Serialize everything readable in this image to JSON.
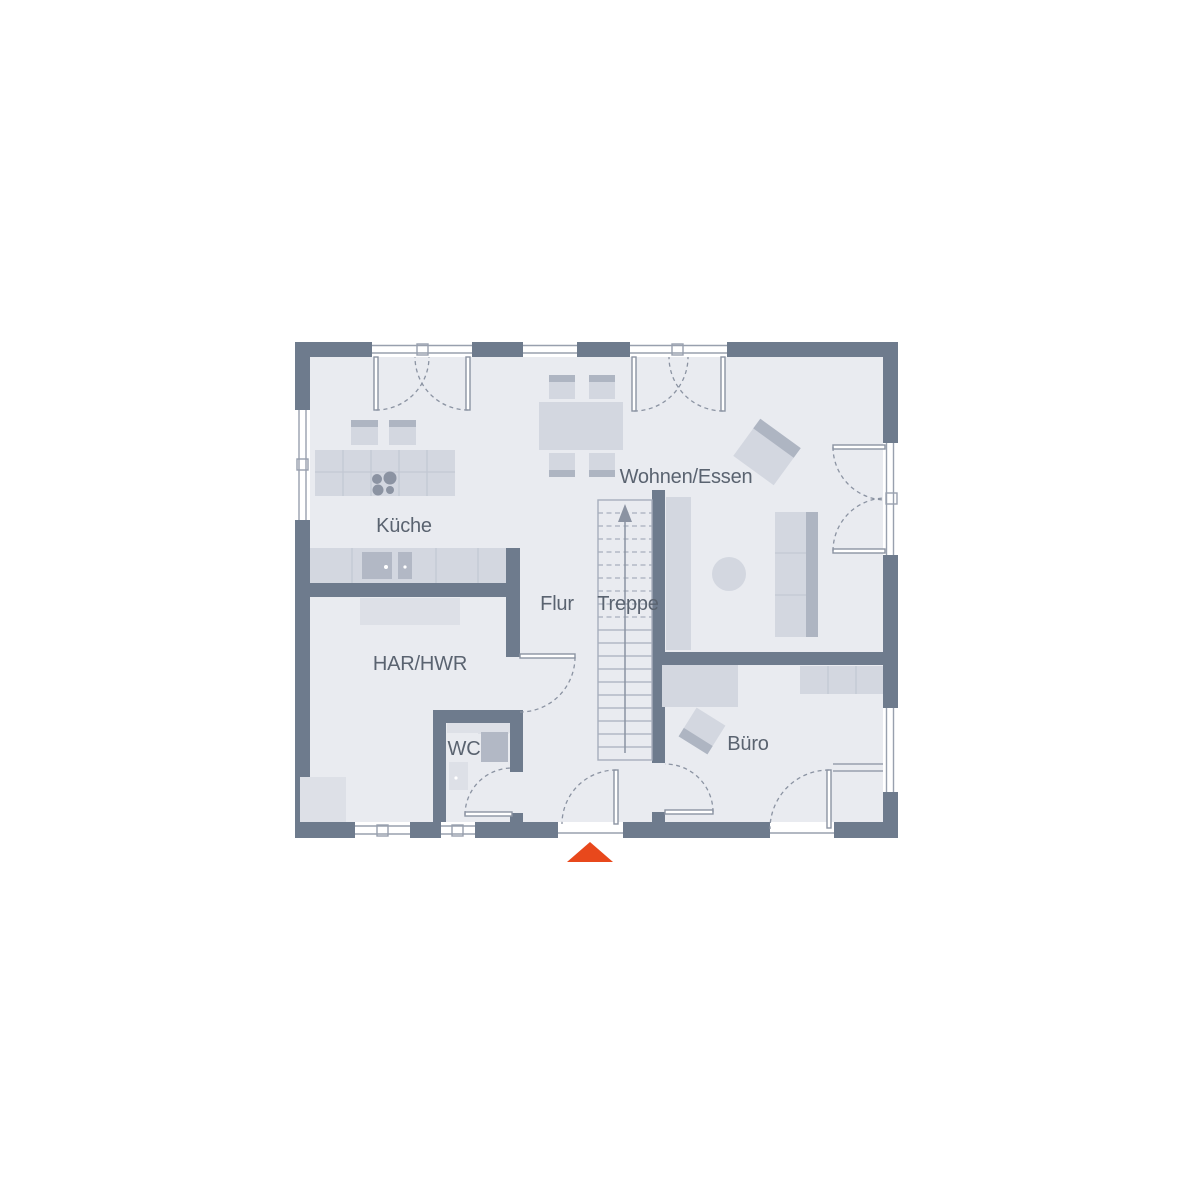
{
  "page": {
    "type": "architectural-floor-plan",
    "background": "#ffffff"
  },
  "floorplan": {
    "labels": {
      "kueche": "Küche",
      "wohnen_essen": "Wohnen/Essen",
      "flur": "Flur",
      "treppe": "Treppe",
      "har_hwr": "HAR/HWR",
      "wc": "WC",
      "buero": "Büro"
    },
    "stairs": {
      "direction": "up"
    },
    "entrance": {
      "marker_shape": "triangle",
      "marker_color": "#e8481c"
    },
    "colors": {
      "background": "#ffffff",
      "wall": "#6e7b8d",
      "floor": "#e9ebf0",
      "furniture": "#d3d7e0",
      "furniture_dark": "#aeb5c2",
      "furniture_light": "#dde0e7",
      "appliance": "#b2b8c5",
      "line": "#8b93a2",
      "window_frame": "#98a0ae",
      "window_fill": "#ffffff",
      "counter_line": "#c3c8d3",
      "stair_line": "#a7aebc",
      "label": "#5a6370",
      "entrance_marker": "#e8481c"
    }
  }
}
